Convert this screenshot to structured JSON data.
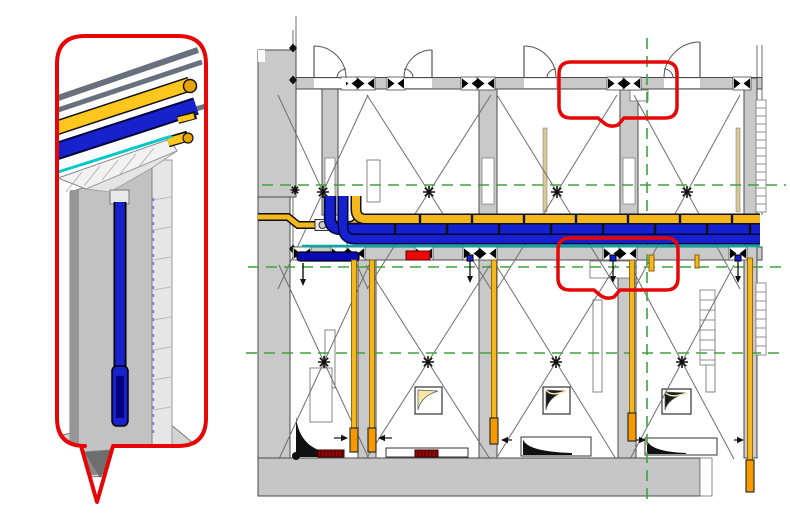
{
  "meta": {
    "view_type": "bim-coordination-figure",
    "description": "Plan view of corridor wall with yellow and blue piping runs, two red highlight callouts, and a 3D wall-section detail bubble showing vertical pipe drop"
  },
  "colors": {
    "background": "#ffffff",
    "wall": "#c9c9c9",
    "wall_dark": "#9a9a9a",
    "wall_stroke": "#4a4a4a",
    "line": "#6e6e6e",
    "grid_green": "#3da43d",
    "pipe_yellow": "#f5b71e",
    "pipe_yellow_dark": "#8a6200",
    "pipe_orange": "#f59b00",
    "pipe_blue": "#1520ce",
    "pipe_blue_dark": "#00053d",
    "teal": "#00a8a8",
    "callout_red": "#e60606",
    "heater_red": "#a00000",
    "bright_red": "#ee0808",
    "steel_gray": "#68707d",
    "fixture_cream": "#f6e8a6",
    "violet_dash": "#8a7fd6",
    "black": "#111111"
  },
  "plan": {
    "grid": {
      "horizontal": [
        {
          "y": 185,
          "x1": 262,
          "x2": 786
        },
        {
          "y": 267,
          "x1": 248,
          "x2": 786
        },
        {
          "y": 353,
          "x1": 246,
          "x2": 786
        }
      ],
      "vertical": [
        {
          "x": 647,
          "y1": 38,
          "y2": 503
        }
      ]
    },
    "stars": {
      "upper_y": 192,
      "upper": [
        323,
        429,
        557,
        687
      ],
      "lower_y": 362,
      "lower": [
        324,
        428,
        556,
        682
      ]
    },
    "braces": {
      "upper_y1": 95,
      "upper_y2": 289,
      "upper": [
        {
          "cx": 323,
          "hw": 45
        },
        {
          "cx": 429,
          "hw": 62
        },
        {
          "cx": 557,
          "hw": 60
        },
        {
          "cx": 687,
          "hw": 53
        }
      ],
      "lower_y1": 265,
      "lower_y2": 459,
      "lower": [
        {
          "cx": 324,
          "hw": 45
        },
        {
          "cx": 428,
          "hw": 62
        },
        {
          "cx": 556,
          "hw": 60
        },
        {
          "cx": 682,
          "hw": 52
        }
      ]
    },
    "doors": [
      {
        "x": 314,
        "w": 32,
        "hinge": "left"
      },
      {
        "x": 404,
        "w": 28,
        "hinge": "right"
      },
      {
        "x": 524,
        "w": 32,
        "hinge": "left"
      },
      {
        "x": 664,
        "w": 36,
        "hinge": "right"
      }
    ],
    "valves": {
      "upper_y": 83.5,
      "upper": [
        350,
        366,
        396,
        470,
        486,
        616,
        632,
        742
      ],
      "upper_diamonds": [
        358,
        478,
        624
      ],
      "lower_y": 253.5,
      "lower": [
        302,
        340,
        356,
        424,
        472,
        488,
        612,
        628,
        738
      ],
      "lower_diamonds": [
        348,
        480,
        620
      ]
    },
    "hangers": {
      "yellow_y": 219,
      "yellow_x": [
        420,
        472,
        524,
        576,
        628,
        680,
        732
      ],
      "blue_y": 229,
      "blue_x": [
        395,
        447,
        499,
        551,
        603,
        655,
        707,
        750
      ]
    },
    "drops": [
      {
        "x": 470
      },
      {
        "x": 613
      },
      {
        "x": 738
      }
    ],
    "stubs": [
      {
        "x": 649,
        "y": 255,
        "w": 5,
        "h": 16
      },
      {
        "x": 695,
        "y": 255,
        "w": 4,
        "h": 13
      }
    ],
    "wall_pipes": [
      {
        "x": 354,
        "y": 260,
        "h": 170,
        "tip_y": 428,
        "tip_h": 24
      },
      {
        "x": 372,
        "y": 260,
        "h": 170,
        "tip_y": 428,
        "tip_h": 24
      },
      {
        "x": 494,
        "y": 260,
        "h": 160,
        "tip_y": 418,
        "tip_h": 26
      },
      {
        "x": 632,
        "y": 260,
        "h": 155,
        "tip_y": 413,
        "tip_h": 28
      },
      {
        "x": 750,
        "y": 258,
        "h": 204,
        "tip_y": 460,
        "tip_h": 32
      }
    ],
    "dim_arrows": [
      {
        "x1": 334,
        "x2": 348,
        "y": 438
      },
      {
        "x1": 392,
        "x2": 378,
        "y": 438
      },
      {
        "x1": 512,
        "x2": 501,
        "y": 440
      },
      {
        "x1": 636,
        "x2": 646,
        "y": 440
      },
      {
        "x1": 734,
        "x2": 744,
        "y": 440
      }
    ],
    "heaters": [
      {
        "x": 318,
        "y": 450,
        "w": 26,
        "h": 7
      },
      {
        "x": 415,
        "y": 450,
        "w": 23,
        "h": 7
      }
    ],
    "fixtures": [
      {
        "x": 415,
        "y": 387,
        "w": 27,
        "h": 27,
        "tone": "cream"
      },
      {
        "x": 543,
        "y": 387,
        "w": 27,
        "h": 27,
        "tone": "dark"
      },
      {
        "x": 662,
        "y": 389,
        "w": 29,
        "h": 25,
        "tone": "dark"
      }
    ],
    "callouts": [
      {
        "x": 559,
        "y": 62,
        "w": 118,
        "h": 56,
        "notch_cx": 604
      },
      {
        "x": 558,
        "y": 238,
        "w": 120,
        "h": 52,
        "notch_cx": 600
      }
    ],
    "studs": [
      {
        "x": 367,
        "y": 160,
        "w": 13,
        "h": 42
      },
      {
        "x": 325,
        "y": 330,
        "w": 10,
        "h": 58
      },
      {
        "x": 593,
        "y": 300,
        "w": 9,
        "h": 92
      },
      {
        "x": 706,
        "y": 330,
        "w": 9,
        "h": 62
      },
      {
        "x": 310,
        "y": 368,
        "w": 22,
        "h": 54
      }
    ],
    "tan_lines": [
      {
        "x": 543,
        "y": 128,
        "w": 4,
        "h": 84
      },
      {
        "x": 736,
        "y": 128,
        "w": 4,
        "h": 84
      }
    ],
    "ladders": [
      {
        "x": 756,
        "y": 100,
        "w": 10,
        "h": 112,
        "step": 8
      },
      {
        "x": 756,
        "y": 283,
        "w": 10,
        "h": 72,
        "step": 9
      },
      {
        "x": 700,
        "y": 290,
        "w": 15,
        "h": 75,
        "step": 10
      }
    ],
    "nodes": [
      {
        "x": 293,
        "y": 48
      },
      {
        "x": 293,
        "y": 80
      },
      {
        "x": 293,
        "y": 222
      },
      {
        "x": 293,
        "y": 249
      }
    ],
    "node_star": {
      "x": 295,
      "y": 190
    }
  }
}
